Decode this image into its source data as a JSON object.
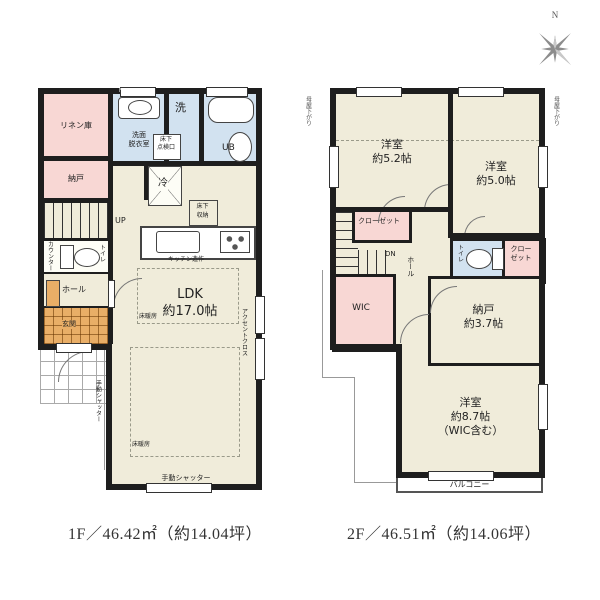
{
  "palette": {
    "wall": "#1e1e1e",
    "room_cream": "#f0ecda",
    "room_pink": "#f8d7d4",
    "room_blue": "#d2e2f0",
    "entrance_orange": "#e9ae67"
  },
  "compass": {
    "north": "N"
  },
  "floor1": {
    "caption": "1F／46.42㎡（約14.04坪）",
    "wall_tag": "FG=32",
    "rooms": {
      "linen": "リネン庫",
      "storage": "納戸",
      "washroom": "洗面\n脱衣室",
      "laundry": "洗",
      "bath": "UB",
      "hatch": "床下\n点検口",
      "fridge": "冷",
      "underfloor_storage": "床下\n収納",
      "stairs_up": "UP",
      "counter": "カウンター",
      "toilet": "トイレ",
      "hall": "ホール",
      "entrance": "玄関",
      "ldk": "LDK\n約17.0帖",
      "kitchen_note": "キッチン造作",
      "floor_heating": "床暖房",
      "accent_cloth": "アクセントクロス",
      "manual_shutter": "手動シャッター"
    }
  },
  "floor2": {
    "caption": "2F／46.51㎡（約14.06坪）",
    "rooms": {
      "bedroom_52": "洋室\n約5.2帖",
      "bedroom_50": "洋室\n約5.0帖",
      "closet_left": "クローゼット",
      "closet_right": "クロー\nゼット",
      "stairs_down": "DN",
      "hall": "ホール",
      "toilet": "トイレ",
      "wic": "WIC",
      "storage": "納戸\n約3.7帖",
      "bedroom_87": "洋室\n約8.7帖\n（WIC含む）",
      "balcony": "バルコニー",
      "moya_sagari": "母屋下がり"
    }
  }
}
